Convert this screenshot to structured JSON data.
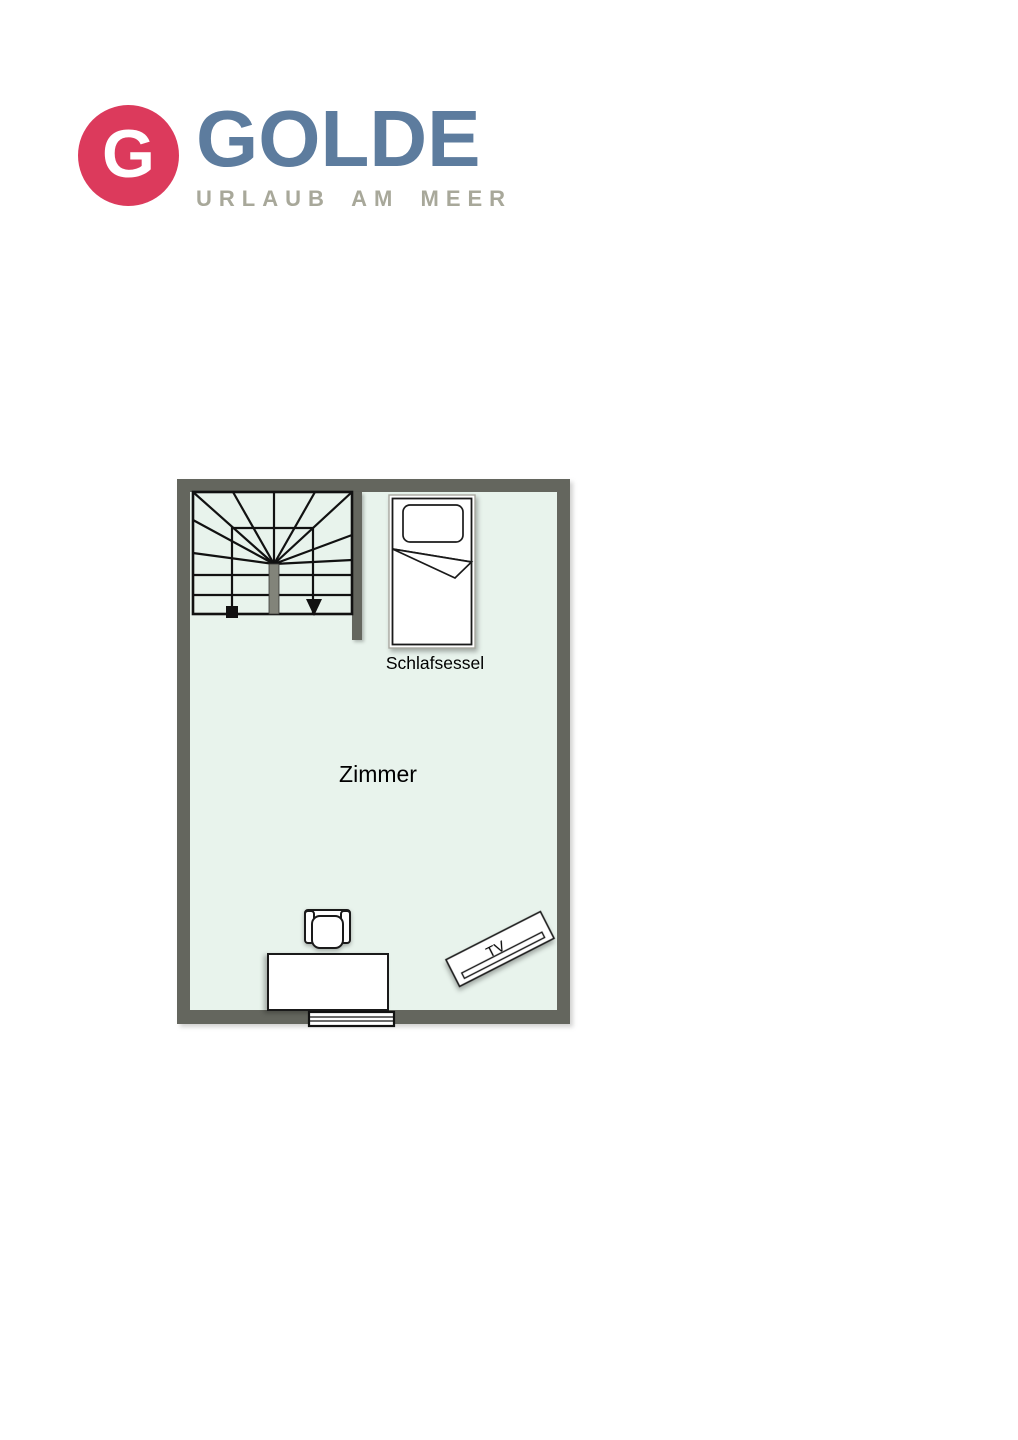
{
  "page": {
    "background": "#ffffff"
  },
  "logo": {
    "monogram": "G",
    "brand": "GOLDE",
    "tagline": "URLAUB AM MEER",
    "colors": {
      "badge": "#dc3a5c",
      "brand": "#5d7c9e",
      "tagline": "#a8a89a"
    }
  },
  "floorplan": {
    "room_label": "Zimmer",
    "furniture_labels": {
      "sleeping_chair": "Schlafsessel",
      "tv": "TV"
    },
    "colors": {
      "wall": "#64665e",
      "floor": "#e8f3ec",
      "outline": "#111111",
      "newel": "#82847a"
    }
  }
}
